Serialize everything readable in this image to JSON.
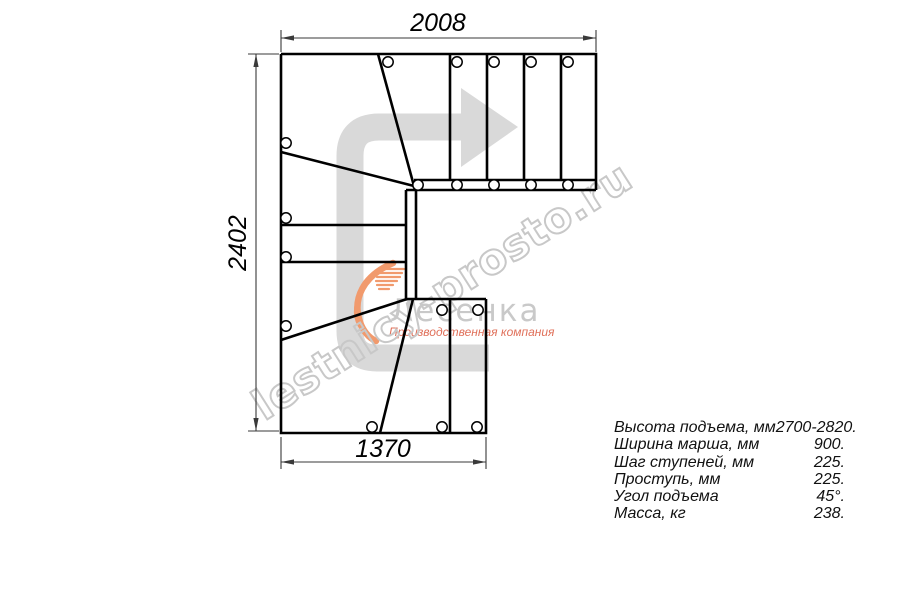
{
  "watermark": {
    "text": "lestnicy-prosto.ru"
  },
  "logo": {
    "name": "Лесенка",
    "tagline": "Производственная компания"
  },
  "plan": {
    "dim_top": "2008",
    "dim_left": "2402",
    "dim_bottom": "1370"
  },
  "specs": {
    "rows": [
      {
        "label": "Высота подъема, мм",
        "value": "2700-2820."
      },
      {
        "label": "Ширина марша, мм",
        "value": "900."
      },
      {
        "label": "Шаг ступеней, мм",
        "value": "225."
      },
      {
        "label": "Проступь, мм",
        "value": "225."
      },
      {
        "label": "Угол подъема",
        "value": "45°."
      },
      {
        "label": "Масса, кг",
        "value": "238."
      }
    ]
  },
  "colors": {
    "line": "#000000",
    "direction_arrow": "#d9d9d9",
    "watermark": "#c8c8c8",
    "logo_accent": "#f19a6d",
    "logo_text": "#c9c9c9",
    "logo_tagline": "#e0705a"
  }
}
